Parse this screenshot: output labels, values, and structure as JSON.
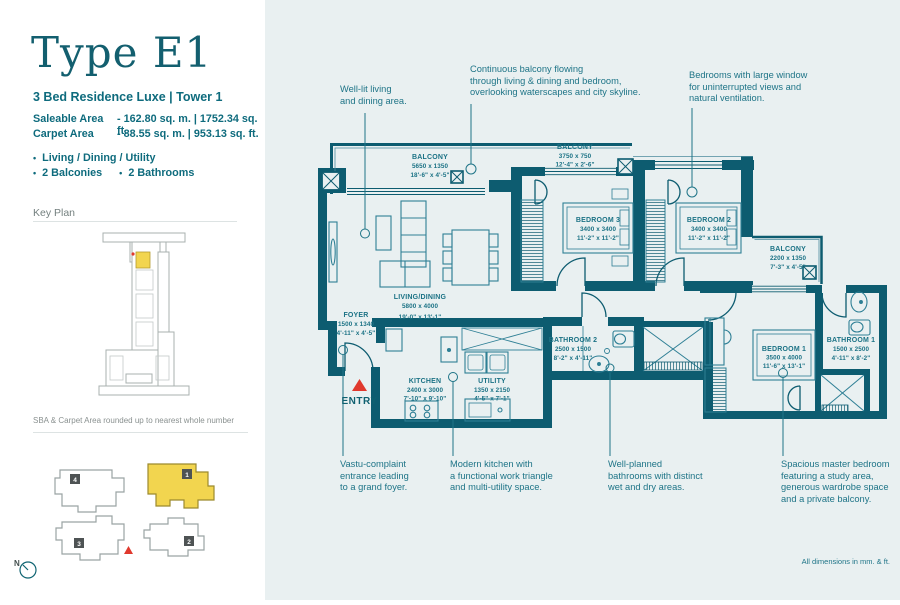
{
  "sidebar": {
    "title": "Type E1",
    "subtitle": "3 Bed Residence Luxe  |  Tower 1",
    "areas": [
      {
        "label": "Saleable Area",
        "value": "-  162.80 sq. m.   |   1752.34 sq. ft."
      },
      {
        "label": "Carpet Area",
        "value": "-  88.55 sq. m.    |   953.13 sq. ft."
      }
    ],
    "features": [
      "Living / Dining / Utility",
      "2 Balconies",
      "2 Bathrooms"
    ],
    "key_plan_heading": "Key Plan",
    "footnote": "SBA & Carpet Area rounded up to nearest whole number",
    "north_label": "N",
    "tower_badges": [
      "1",
      "2",
      "3",
      "4"
    ]
  },
  "plan": {
    "rooms": [
      {
        "name": "BALCONY",
        "mm": "5650 x 1350",
        "ft": "18'-6\" x 4'-5\""
      },
      {
        "name": "BALCONY",
        "mm": "3750 x 750",
        "ft": "12'-4\" x 2'-6\""
      },
      {
        "name": "BEDROOM 3",
        "mm": "3400 x 3400",
        "ft": "11'-2\" x 11'-2\""
      },
      {
        "name": "BEDROOM 2",
        "mm": "3400 x 3400",
        "ft": "11'-2\" x 11'-2\""
      },
      {
        "name": "BALCONY",
        "mm": "2200 x 1350",
        "ft": "7'-3\" x 4'-5\""
      },
      {
        "name": "LIVING/DINING",
        "mm": "5800 x 4000",
        "ft": "19'-0\" x 13'-1\""
      },
      {
        "name": "FOYER",
        "mm": "1500 x 1340",
        "ft": "4'-11\" x 4'-5\""
      },
      {
        "name": "KITCHEN",
        "mm": "2400 x 3000",
        "ft": "7'-10\" x 9'-10\""
      },
      {
        "name": "UTILITY",
        "mm": "1350 x 2150",
        "ft": "4'-5\" x 7'-1\""
      },
      {
        "name": "BATHROOM 2",
        "mm": "2500 x 1500",
        "ft": "8'-2\" x 4'-11\""
      },
      {
        "name": "BEDROOM 1",
        "mm": "3500 x 4000",
        "ft": "11'-6\" x 13'-1\""
      },
      {
        "name": "BATHROOM 1",
        "mm": "1500 x 2500",
        "ft": "4'-11\" x 8'-2\""
      }
    ],
    "entry_label": "ENTRY",
    "dimensions_note": "All dimensions in mm. & ft.",
    "annotations_top": [
      "Well-lit living\nand dining area.",
      "Continuous balcony flowing\nthrough living & dining and bedroom,\noverlooking waterscapes and city skyline.",
      "Bedrooms with large window\nfor uninterrupted views and\nnatural ventilation."
    ],
    "annotations_bottom": [
      "Vastu-complaint\nentrance leading\nto a grand foyer.",
      "Modern kitchen with\na functional work triangle\nand multi-utility space.",
      "Well-planned\nbathrooms with distinct\nwet and dry areas.",
      "Spacious master bedroom\nfeaturing a study area,\ngenerous wardrobe space\nand a private balcony."
    ]
  },
  "colors": {
    "wall": "#0d5c70",
    "accent_red": "#e0392e",
    "highlight_yellow": "#f2d54f"
  }
}
